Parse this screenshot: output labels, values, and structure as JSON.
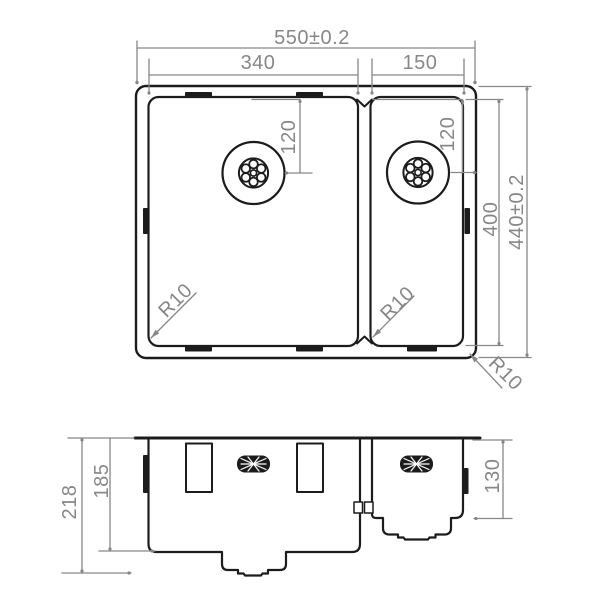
{
  "top_view": {
    "overall_width": "550±0.2",
    "left_bowl_width": "340",
    "right_bowl_width": "150",
    "left_drain_offset": "120",
    "right_drain_offset": "120",
    "inner_depth": "400",
    "overall_depth": "440±0.2",
    "left_bowl_corner_radius": "R10",
    "right_bowl_corner_radius": "R10",
    "outer_corner_radius": "R10"
  },
  "front_view": {
    "total_height": "218",
    "left_bowl_height": "185",
    "right_bowl_height": "130"
  },
  "colors": {
    "outline": "#1c1c1c",
    "dimension": "#878787",
    "background": "#ffffff"
  }
}
